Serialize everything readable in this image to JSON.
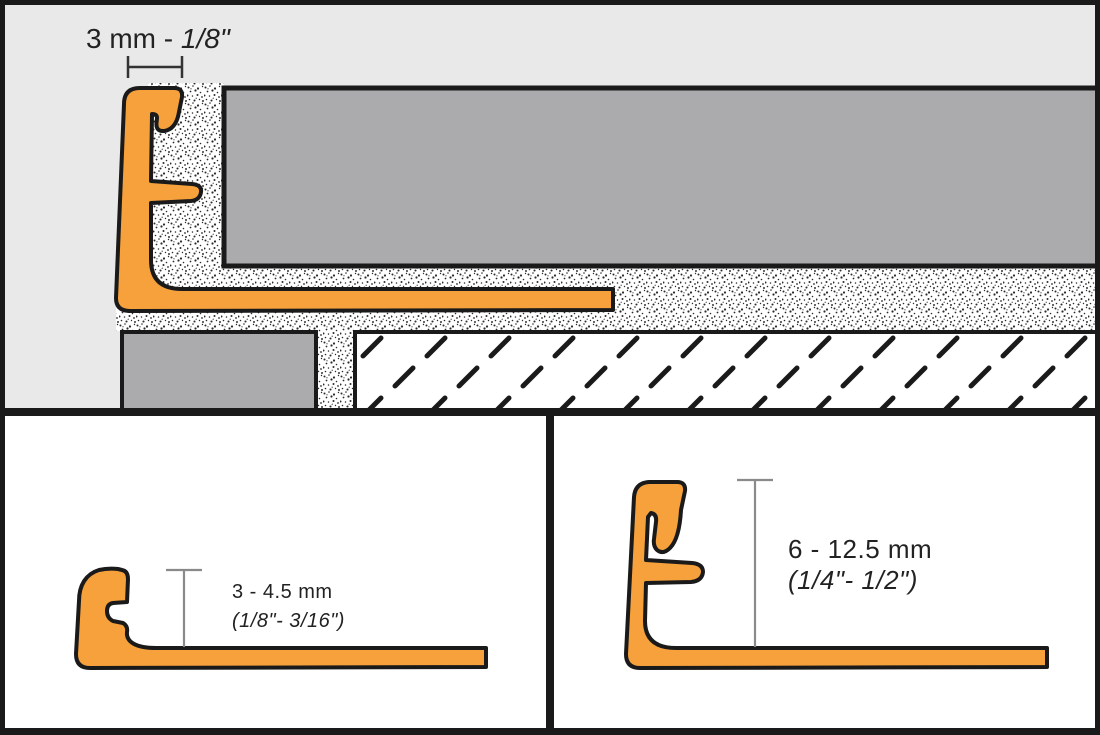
{
  "colors": {
    "profile-orange": "#F6A13C",
    "outline": "#1A1A1A",
    "panel-bg": "#E9E9E9",
    "paper": "#FFFFFF",
    "tile-gray": "#ABABAD",
    "text": "#222222",
    "dim-dark": "#333333",
    "dim-light": "#8A8A8A"
  },
  "top_panel": {
    "dimension_label": {
      "regular": "3 mm - ",
      "italic": "1/8\""
    }
  },
  "bottom_left_panel": {
    "dimension_label": {
      "line1": "3 - 4.5 mm",
      "line2": "(1/8\"- 3/16\")"
    }
  },
  "bottom_right_panel": {
    "dimension_label": {
      "line1": "6 - 12.5 mm",
      "line2": "(1/4\"- 1/2\")"
    }
  }
}
